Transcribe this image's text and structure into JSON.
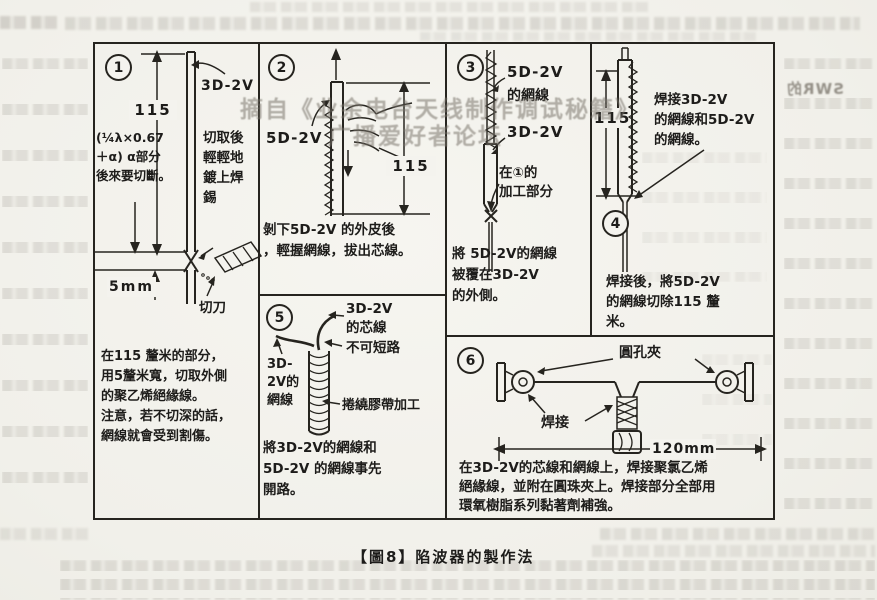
{
  "caption": "【圖8】陷波器的製作法",
  "watermark": {
    "line1": "摘自《业余电台天线制作调试秘籍》",
    "line2": "广播爱好者论坛"
  },
  "ghost": {
    "mirrored_heading": "SWR的"
  },
  "panels": {
    "p1": {
      "num": "1",
      "cable_label": "3D-2V",
      "dim": "115",
      "formula": "(¼λ×0.67\n＋α) α部分\n後來要切斷。",
      "solder_note": "切取後\n輕輕地\n鍍上焊\n錫",
      "gap_label": "5mm",
      "knife_label": "切刀",
      "note": "在115 釐米的部分，\n用5釐米寬，切取外側\n的聚乙烯絕緣線。\n注意，若不切深的話，\n網線就會受到割傷。"
    },
    "p2": {
      "num": "2",
      "cable_label": "5D-2V",
      "dim": "115",
      "note": "剝下5D-2V 的外皮後\n，輕握網線，拔出芯線。"
    },
    "p3": {
      "num": "3",
      "label_5d": "5D-2V",
      "label_5d_braid": "的網線",
      "label_3d": "3D-2V",
      "label_work": "在①的\n加工部分",
      "note": "將 5D-2V的網線\n被覆在3D-2V\n的外側。"
    },
    "p4": {
      "num": "4",
      "dim": "115",
      "label_solder": "焊接3D-2V\n的網線和5D-2V\n的網線。",
      "note": "焊接後，將5D-2V\n的網線切除115 釐\n米。"
    },
    "p5": {
      "num": "5",
      "label_core": "3D-2V\n的芯線",
      "label_no_short": "不可短路",
      "label_braid": "3D-\n2V的\n網線",
      "label_tape": "捲繞膠帶加工",
      "note": "將3D-2V的網線和\n5D-2V 的網線事先\n開路。"
    },
    "p6": {
      "num": "6",
      "label_clamp": "圓孔夾",
      "label_solder": "焊接",
      "dim": "120mm",
      "note": "在3D-2V的芯線和網線上，焊接聚氯乙烯\n絕緣線，並附在圓珠夾上。焊接部分全部用\n環氧樹脂系列黏著劑補強。"
    }
  }
}
